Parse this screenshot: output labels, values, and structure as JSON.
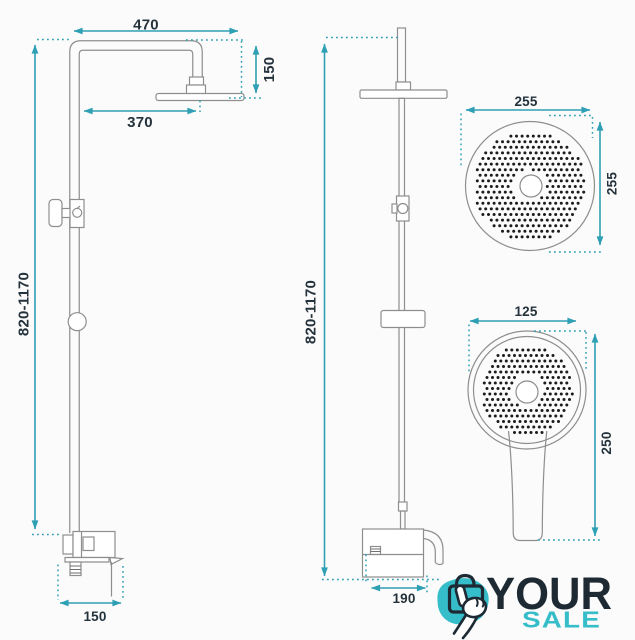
{
  "diagram": {
    "side_view": {
      "top_width": "470",
      "head_offset": "150",
      "arm_reach": "370",
      "height_range": "820-1170",
      "base_depth": "150"
    },
    "front_view": {
      "height_range": "820-1170",
      "base_width": "190"
    },
    "rain_head": {
      "width": "255",
      "height": "255"
    },
    "hand_shower": {
      "width": "125",
      "height": "250"
    }
  },
  "logo": {
    "word_top": "YOUR",
    "word_bottom": "SALE"
  },
  "colors": {
    "dimension_teal": "#2f9fb4",
    "drawing_gray": "#8e8e8e",
    "nozzle_black": "#1c1c1c",
    "label_dark": "#24323c",
    "logo_navy": "#1d2a33",
    "logo_teal": "#35bdca",
    "background": "#fbfbfb"
  }
}
